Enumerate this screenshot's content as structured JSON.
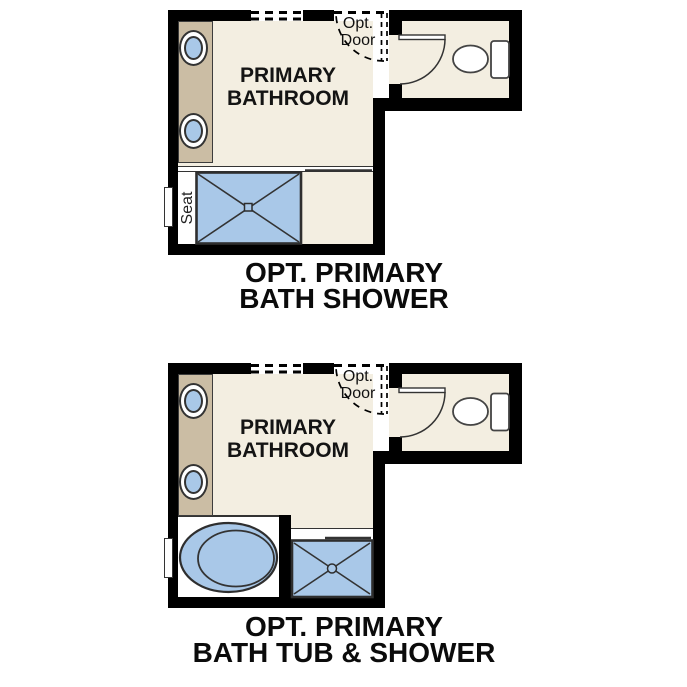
{
  "colors": {
    "wall": "#000000",
    "floor": "#f3eee1",
    "vanity": "#cbbda4",
    "fixture": "#a9c8e8",
    "text": "#141414",
    "background": "#ffffff"
  },
  "plan_top": {
    "room_label": {
      "line1": "PRIMARY",
      "line2": "BATHROOM"
    },
    "opt_door": {
      "line1": "Opt.",
      "line2": "Door"
    },
    "seat_label": "Seat",
    "caption": {
      "line1": "OPT. PRIMARY",
      "line2": "BATH SHOWER"
    },
    "fixtures": [
      "double-sink-vanity",
      "shower-with-seat",
      "toilet",
      "optional-door"
    ]
  },
  "plan_bottom": {
    "room_label": {
      "line1": "PRIMARY",
      "line2": "BATHROOM"
    },
    "opt_door": {
      "line1": "Opt.",
      "line2": "Door"
    },
    "caption": {
      "line1": "OPT. PRIMARY",
      "line2": "BATH TUB & SHOWER"
    },
    "fixtures": [
      "double-sink-vanity",
      "bathtub",
      "shower",
      "toilet",
      "optional-door"
    ]
  }
}
